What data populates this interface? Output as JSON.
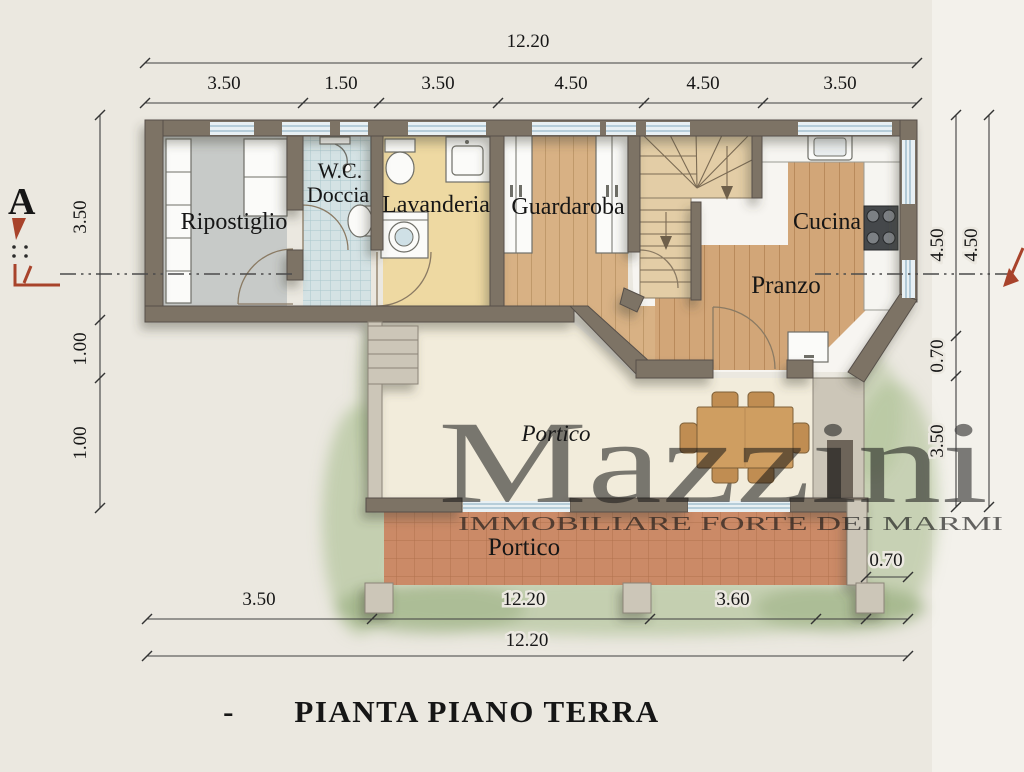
{
  "page": {
    "background": "#ebe8e0"
  },
  "title": {
    "prefix": "-",
    "text": "PIANTA PIANO TERRA"
  },
  "watermark": {
    "name": "Mazzini",
    "subtitle": "IMMOBILIARE FORTE DEI MARMI"
  },
  "section_marker": {
    "label": "A"
  },
  "rooms": {
    "ripostiglio": {
      "label": "Ripostiglio"
    },
    "wc": {
      "line1": "W.C.",
      "line2": "Doccia"
    },
    "lavanderia": {
      "label": "Lavanderia"
    },
    "guardaroba": {
      "label": "Guardaroba"
    },
    "cucina": {
      "label": "Cucina"
    },
    "pranzo": {
      "label": "Pranzo"
    },
    "portico_upper": {
      "label": "Portico"
    },
    "portico_lower": {
      "label": "Portico"
    }
  },
  "dimensions": {
    "top_total": "12.20",
    "top_segments": [
      "3.50",
      "1.50",
      "3.50",
      "4.50",
      "4.50",
      "3.50"
    ],
    "left_segments": [
      "3.50",
      "1.00",
      "1.00"
    ],
    "right_inner_segments": [
      "4.50",
      "0.70",
      "3.50"
    ],
    "right_outer_total": "4.50",
    "bottom_segments": [
      "3.50",
      "12.20",
      "3.60"
    ],
    "bottom_offset": "0.70",
    "bottom_total": "12.20"
  },
  "colors": {
    "wall": "#7d7365",
    "wood": "#d8b184",
    "terracotta": "#cb8a67",
    "watermark_blue": "#6d83bd",
    "marker_red": "#a8432b",
    "paper": "#ebe8e0"
  }
}
